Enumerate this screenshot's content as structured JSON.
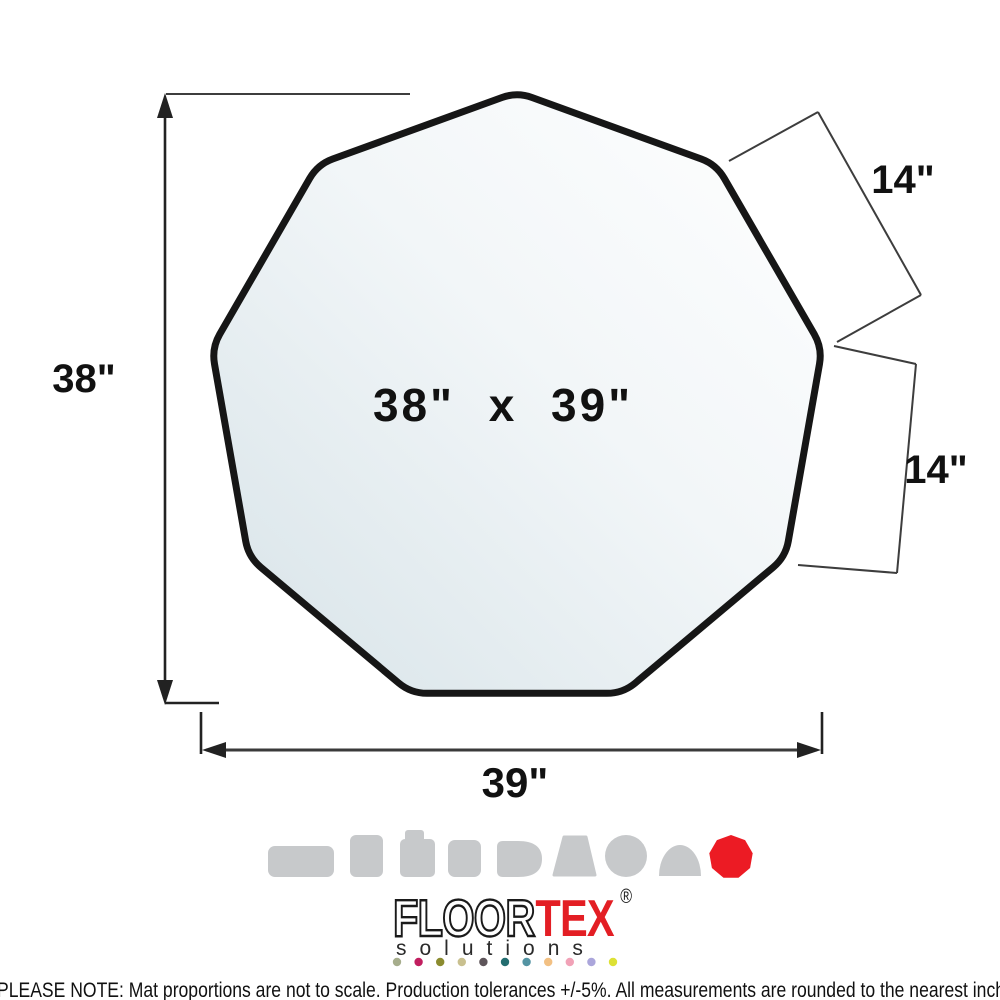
{
  "diagram": {
    "center_label": "38\" x 39\"",
    "height_label": "38\"",
    "width_label": "39\"",
    "edge_top_label": "14\"",
    "edge_right_label": "14\"",
    "outline_color": "#161616",
    "fill_light": "#ffffff",
    "fill_mid": "#f2f6f8",
    "fill_shade": "#d7e3e8"
  },
  "shape_icons": {
    "gray": "#c7c9cb",
    "active_color": "#ec1b24",
    "active_shape": "nonagon",
    "items": [
      "rectangle-wide",
      "rectangle-tall",
      "workstation-lip",
      "square",
      "d-end",
      "trapezoid",
      "circle",
      "contour-dome",
      "nonagon"
    ]
  },
  "logo": {
    "name_part1": "FLOOR",
    "name_part2": "TEX",
    "registered": "®",
    "tagline": "solutions",
    "accent": "#e31e24",
    "dot_colors": [
      "#a6ad8c",
      "#c11e5f",
      "#8b8b2f",
      "#c9c08f",
      "#5e555a",
      "#236d70",
      "#5494a3",
      "#f2c083",
      "#f1a2b7",
      "#aba6db",
      "#dde135"
    ]
  },
  "footnote": "PLEASE NOTE: Mat proportions are not to scale. Production tolerances +/-5%. All measurements are rounded to the nearest inch"
}
